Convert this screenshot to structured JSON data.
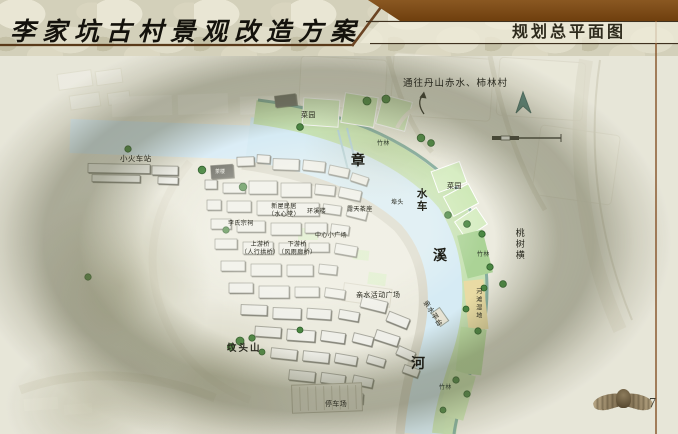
{
  "header": {
    "title": "李家坑古村景观改造方案",
    "section_title": "规划总平面图"
  },
  "footer": {
    "page_number": "7"
  },
  "map": {
    "labels": {
      "route_hint": "通往丹山赤水、柿林村",
      "station": "小火车站",
      "garden_top": "菜园",
      "garden_right": "菜园",
      "bamboo_top": "竹林",
      "bamboo_right": "竹林",
      "bamboo_bottom": "竹林",
      "river_zhang": "章",
      "river_xi": "溪",
      "river_he": "河",
      "waterwheel": "水车",
      "tea_seats": "露天茶座",
      "wharf": "埠头",
      "huanxi_tower": "环溪楼",
      "shuixin_hall": "新屋民居\n（水心堂）",
      "ancestral_hall": "李氏宗祠",
      "bridge_upstream": "上游桥\n（人行拱桥）",
      "bridge_downstream": "下游桥\n（风雨廊桥）",
      "central_plaza": "中心小广场",
      "activity_plaza": "亲水活动广场",
      "water_platform": "亲水平台",
      "river_beach": "河滩湿地",
      "peach_row": "桃树横",
      "hill": "坟头山",
      "parking": "停车场",
      "teahouse": "茶楼"
    }
  }
}
